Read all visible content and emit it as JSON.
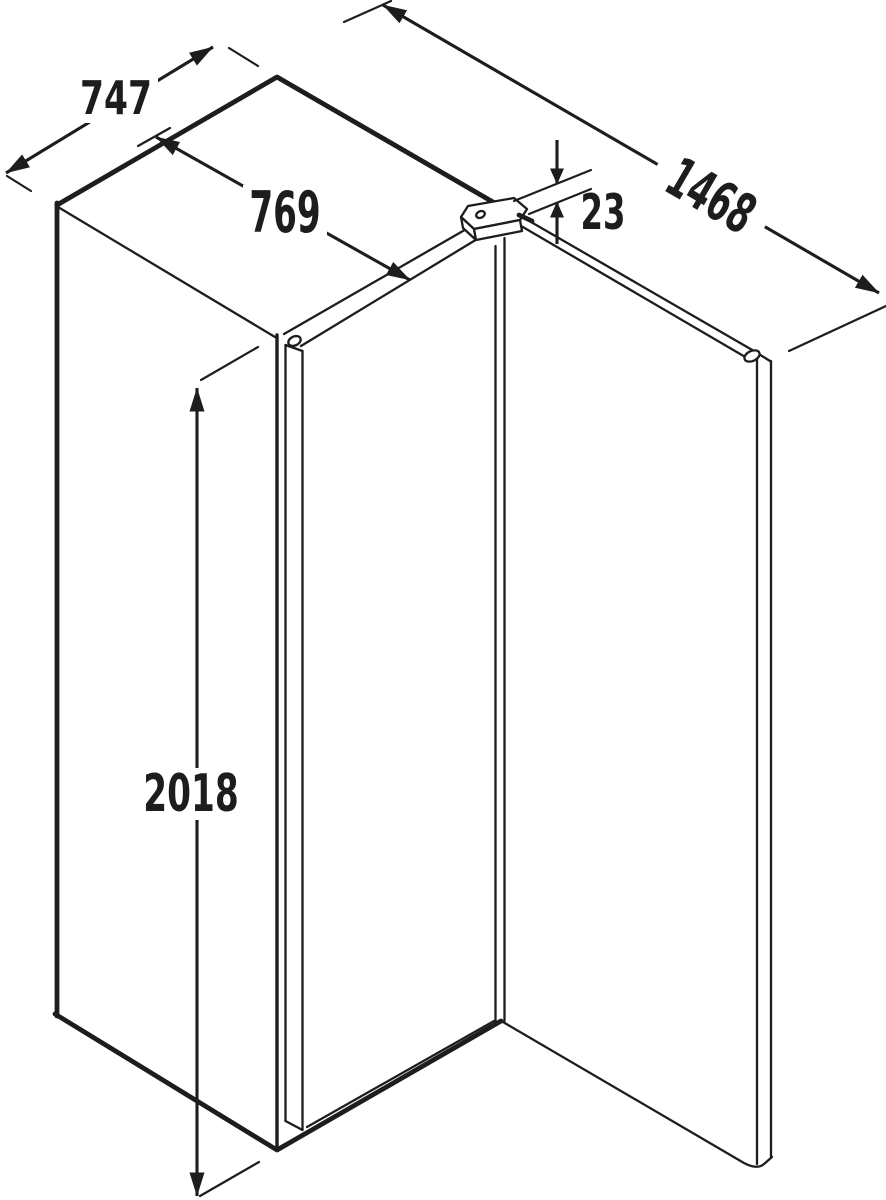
{
  "drawing": {
    "kind": "appliance dimension diagram",
    "ink_color": "#1d1d1b",
    "background_color": "#ffffff"
  },
  "dimensions": {
    "depth": "747",
    "depth_with_door": "769",
    "depth_door_open": "1468",
    "hinge_clearance": "23",
    "height": "2018"
  }
}
